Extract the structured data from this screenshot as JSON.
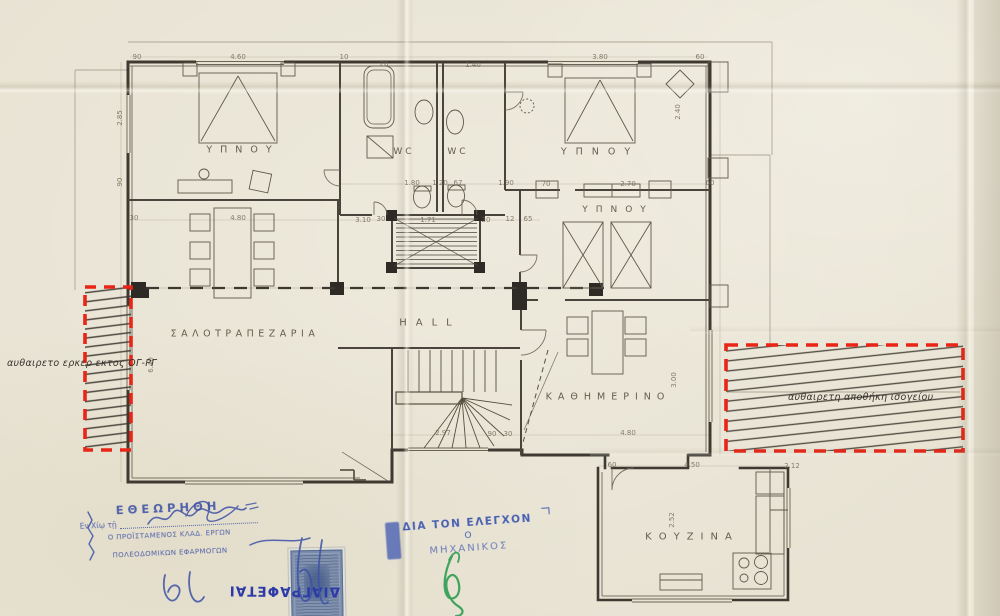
{
  "rooms": [
    {
      "name": "bedroom-top-left",
      "label": "ΥΠΝΟΥ",
      "x": 243,
      "y": 150,
      "ls": 8,
      "fs": 9.5
    },
    {
      "name": "wc-left",
      "label": "WC",
      "x": 404,
      "y": 152,
      "ls": 3,
      "fs": 9
    },
    {
      "name": "wc-right",
      "label": "WC",
      "x": 458,
      "y": 152,
      "ls": 3,
      "fs": 9
    },
    {
      "name": "bedroom-top-right",
      "label": "ΥΠΝΟΥ",
      "x": 600,
      "y": 152,
      "ls": 9,
      "fs": 9.5
    },
    {
      "name": "bedroom-middle",
      "label": "ΥΠΝΟΥ",
      "x": 618,
      "y": 210,
      "ls": 8,
      "fs": 9
    },
    {
      "name": "living-dining",
      "label": "ΣΑΛΟΤΡΑΠΕΖΑΡΙΑ",
      "x": 245,
      "y": 334,
      "ls": 4.5,
      "fs": 9.5
    },
    {
      "name": "hall",
      "label": "HALL",
      "x": 430,
      "y": 323,
      "ls": 9,
      "fs": 10
    },
    {
      "name": "daily-room",
      "label": "ΚΑΘΗΜΕΡΙΝΟ",
      "x": 608,
      "y": 397,
      "ls": 6,
      "fs": 9.5
    },
    {
      "name": "kitchen",
      "label": "ΚΟΥΖΙΝΑ",
      "x": 692,
      "y": 537,
      "ls": 7,
      "fs": 10
    }
  ],
  "annotations": [
    {
      "name": "left-violation",
      "text": "αυθαιρετο ερκερ εκτος ΟΓ-ΡΓ",
      "x": 7,
      "y": 358
    },
    {
      "name": "right-violation",
      "text": "αυθαιρετη αποθήκη ισογείου",
      "x": 788,
      "y": 392
    }
  ],
  "dimensions": [
    {
      "t": "90",
      "x": 137,
      "y": 57
    },
    {
      "t": "4.60",
      "x": 238,
      "y": 57
    },
    {
      "t": "10",
      "x": 344,
      "y": 57
    },
    {
      "t": "20",
      "x": 384,
      "y": 64
    },
    {
      "t": "1.40",
      "x": 473,
      "y": 65
    },
    {
      "t": "3.80",
      "x": 600,
      "y": 57
    },
    {
      "t": "60",
      "x": 700,
      "y": 57
    },
    {
      "t": "2.85",
      "x": 120,
      "y": 118,
      "rot": 1
    },
    {
      "t": "90",
      "x": 120,
      "y": 182,
      "rot": 1
    },
    {
      "t": "2.40",
      "x": 678,
      "y": 112,
      "rot": 1
    },
    {
      "t": "1.80",
      "x": 412,
      "y": 183
    },
    {
      "t": "1.20",
      "x": 440,
      "y": 183
    },
    {
      "t": "67",
      "x": 458,
      "y": 183
    },
    {
      "t": "1.90",
      "x": 506,
      "y": 183
    },
    {
      "t": "70",
      "x": 546,
      "y": 184
    },
    {
      "t": "2.70",
      "x": 628,
      "y": 184
    },
    {
      "t": "60",
      "x": 710,
      "y": 183
    },
    {
      "t": "30",
      "x": 134,
      "y": 218
    },
    {
      "t": "4.80",
      "x": 238,
      "y": 218
    },
    {
      "t": "3.10",
      "x": 363,
      "y": 220
    },
    {
      "t": "30",
      "x": 381,
      "y": 219
    },
    {
      "t": "1.71",
      "x": 428,
      "y": 220
    },
    {
      "t": "20",
      "x": 486,
      "y": 220
    },
    {
      "t": "12",
      "x": 510,
      "y": 219
    },
    {
      "t": "65",
      "x": 528,
      "y": 219
    },
    {
      "t": "3.00",
      "x": 674,
      "y": 380,
      "rot": 1
    },
    {
      "t": "2.97",
      "x": 443,
      "y": 433
    },
    {
      "t": "90",
      "x": 492,
      "y": 434
    },
    {
      "t": "30",
      "x": 508,
      "y": 434
    },
    {
      "t": "4.80",
      "x": 628,
      "y": 433
    },
    {
      "t": "60",
      "x": 612,
      "y": 465
    },
    {
      "t": "4.50",
      "x": 692,
      "y": 465
    },
    {
      "t": "2.12",
      "x": 792,
      "y": 466
    },
    {
      "t": "2.52",
      "x": 672,
      "y": 520,
      "rot": 1
    },
    {
      "t": "6.40",
      "x": 151,
      "y": 365,
      "rot": 1
    }
  ],
  "stamps": {
    "reviewed": {
      "line1": "ΕΘΕΩΡΗΘΗ",
      "line2": "Εν Χίῳ τῇ",
      "line3": "Ο ΠΡΟΪΣΤΑΜΕΝΟΣ ΚΛΑΔ. ΕΡΓΩΝ",
      "line4": "ΠΟΛΕΟΔΟΜΙΚΩΝ ΕΦΑΡΜΟΓΩΝ"
    },
    "control": {
      "line1": "ΔΙΑ ΤΟΝ ΕΛΕΓΧΟΝ",
      "line2": "Ο",
      "line3": "ΜΗΧΑΝΙΚΟΣ"
    },
    "cancel": {
      "text": "ΔΙΑΓΡΑΦΕΤΑΙ"
    }
  },
  "colors": {
    "paper": "#e8e3d3",
    "ink_heavy": "#3e3a32",
    "ink_light": "#9a9180",
    "pencil_text": "#564f3e",
    "violation_red": "#e82517",
    "stamp_blue": "#3d52a6",
    "signature_green": "#2f9e52"
  }
}
